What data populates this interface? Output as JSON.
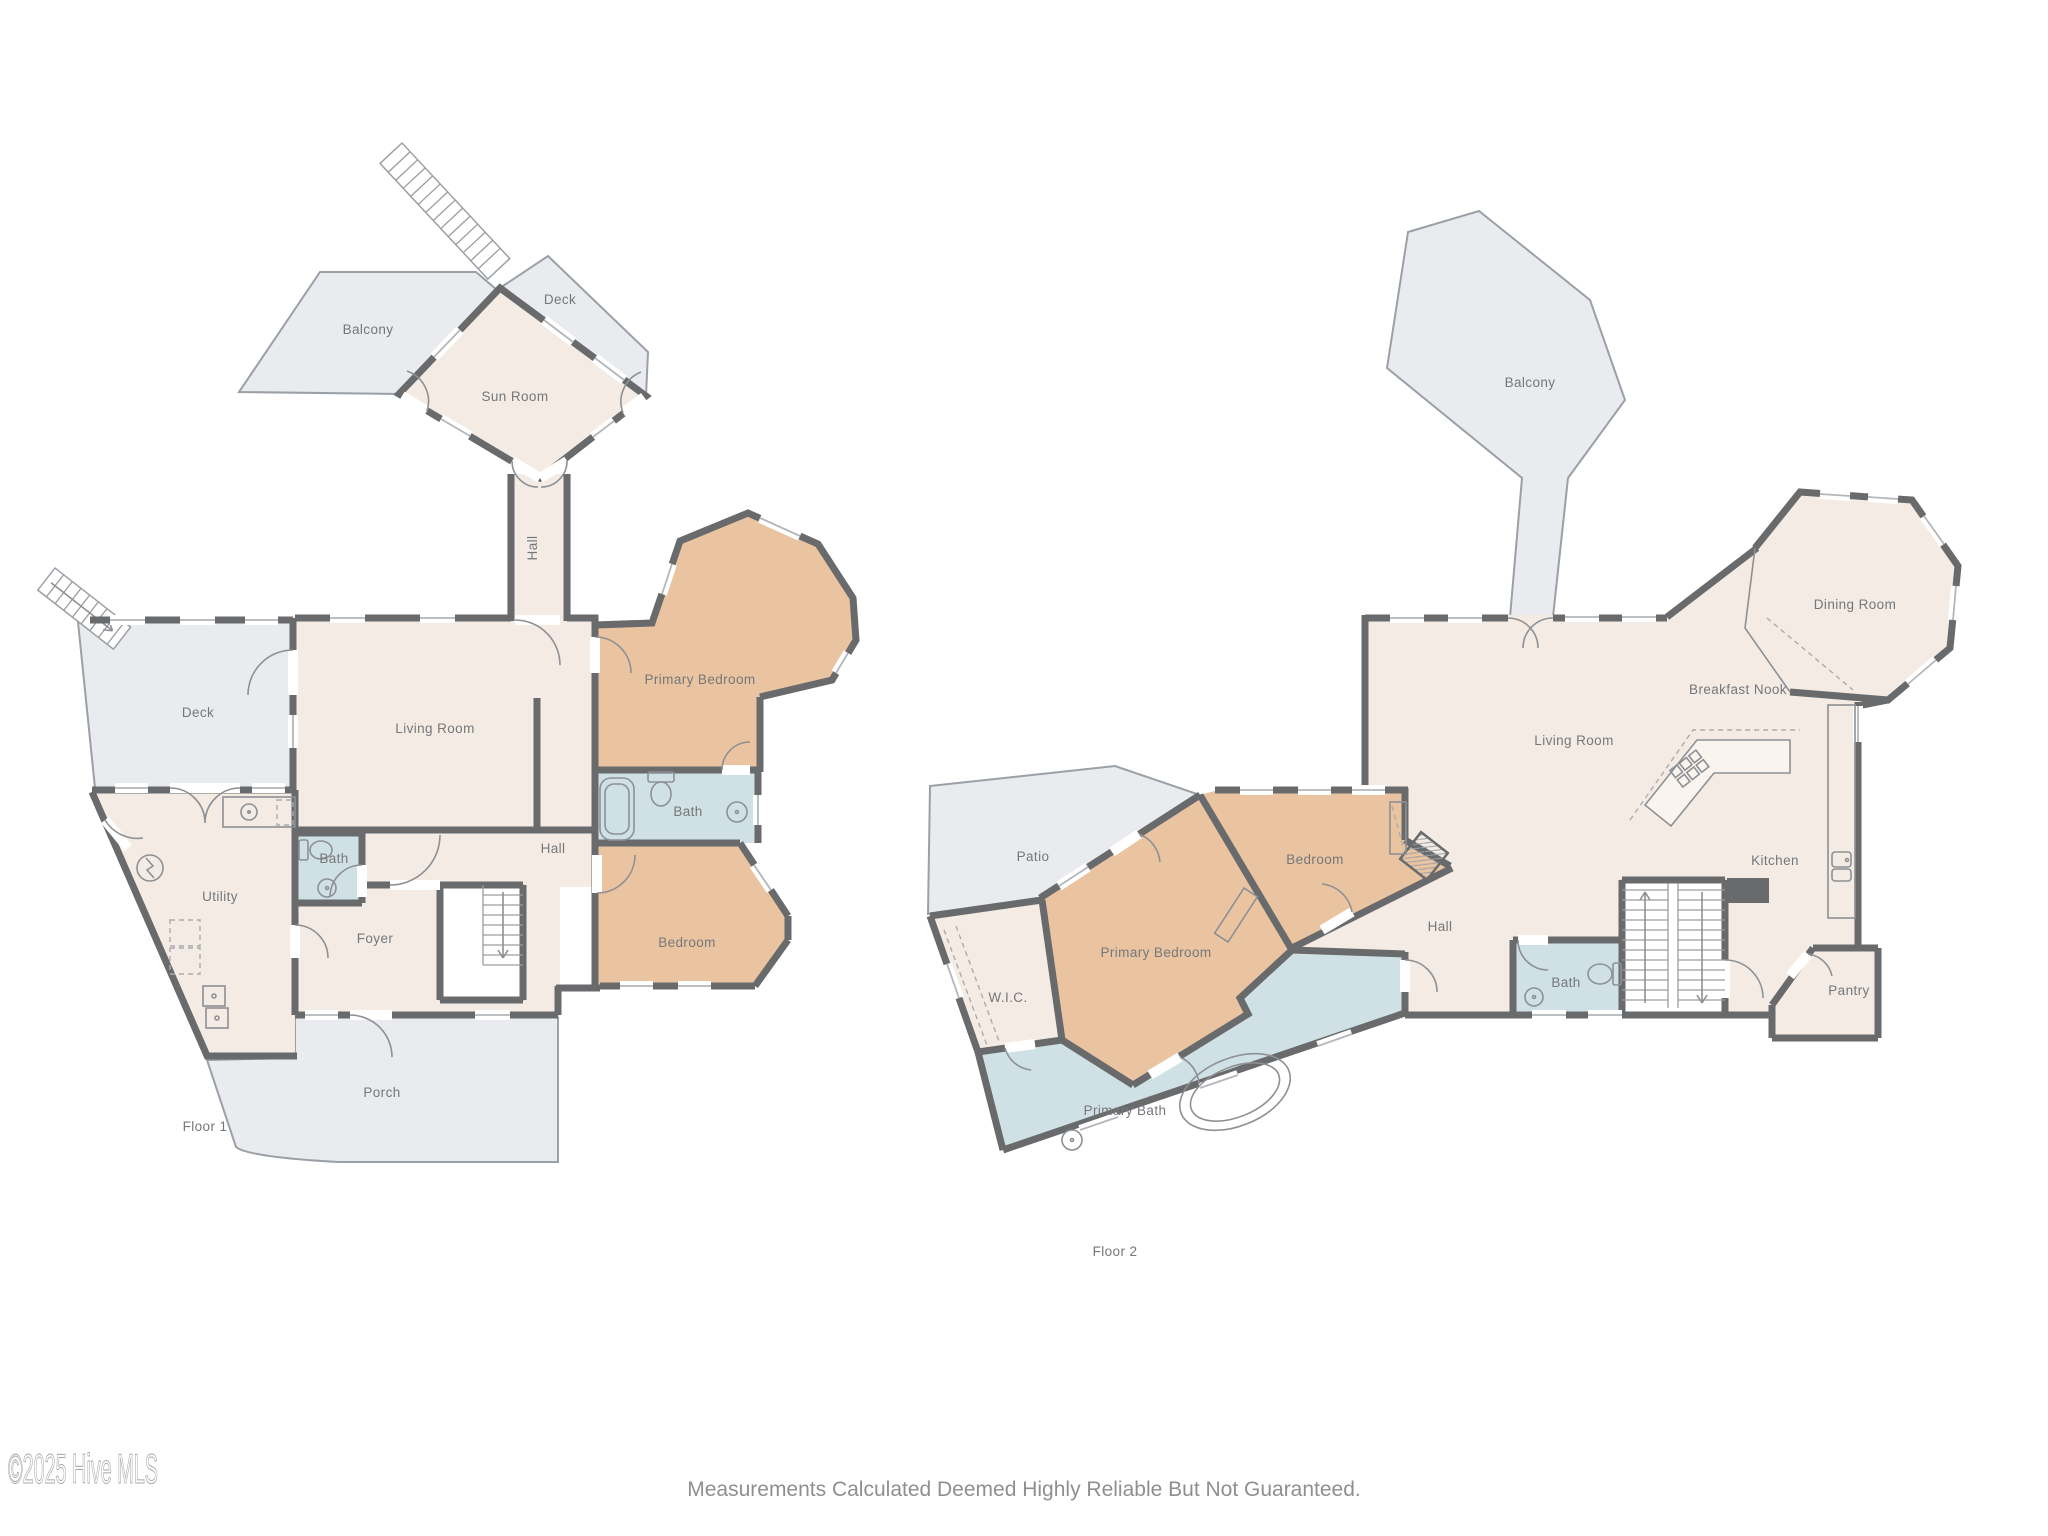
{
  "page": {
    "watermark": "©2025 Hive MLS",
    "footer": "Measurements Calculated Deemed Highly Reliable But Not Guaranteed."
  },
  "palette": {
    "interior": "#f4ece4",
    "bedroom_fill": "#eac4a0",
    "bath_fill": "#cfe1e4",
    "outdoor_fill": "#e9ebee",
    "wall": "#686a6c",
    "label_text": "#75777b"
  },
  "floor1": {
    "name": "Floor 1",
    "rooms": {
      "balcony": "Balcony",
      "deck_top": "Deck",
      "sun_room": "Sun Room",
      "hall_upper": "Hall",
      "deck": "Deck",
      "living_room": "Living Room",
      "primary_bedroom": "Primary Bedroom",
      "bath": "Bath",
      "hall": "Hall",
      "utility": "Utility",
      "bath_small": "Bath",
      "foyer": "Foyer",
      "bedroom": "Bedroom",
      "porch": "Porch"
    }
  },
  "floor2": {
    "name": "Floor 2",
    "rooms": {
      "balcony": "Balcony",
      "dining_room": "Dining Room",
      "breakfast_nook": "Breakfast Nook",
      "living_room": "Living Room",
      "kitchen": "Kitchen",
      "patio": "Patio",
      "bedroom": "Bedroom",
      "hall": "Hall",
      "primary_bedroom": "Primary Bedroom",
      "wic": "W.I.C.",
      "bath": "Bath",
      "primary_bath": "Primary Bath",
      "pantry": "Pantry"
    }
  }
}
